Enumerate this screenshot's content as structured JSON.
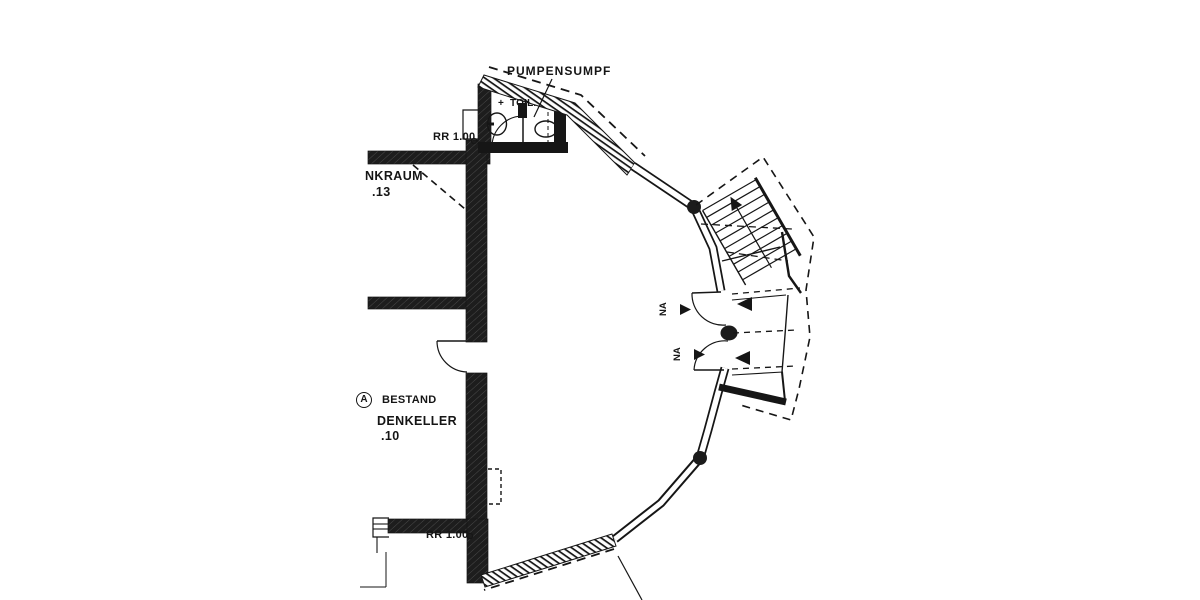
{
  "plan": {
    "annotations": {
      "pumpensumpf": "PUMPENSUMPF",
      "toilet": "TOIL.",
      "toilet_plus": "+",
      "rr_top": "RR 1.00",
      "rr_bottom": "RR 1.00",
      "room_top_name": "NKRAUM",
      "room_top_number": ".13",
      "legend_marker": "A",
      "legend_text": "BESTAND",
      "room_main_name": "DENKELLER",
      "room_main_number": ".10",
      "na_top": "NA",
      "na_bottom": "NA"
    },
    "colors": {
      "ink": "#161616",
      "paper": "#ffffff"
    }
  }
}
